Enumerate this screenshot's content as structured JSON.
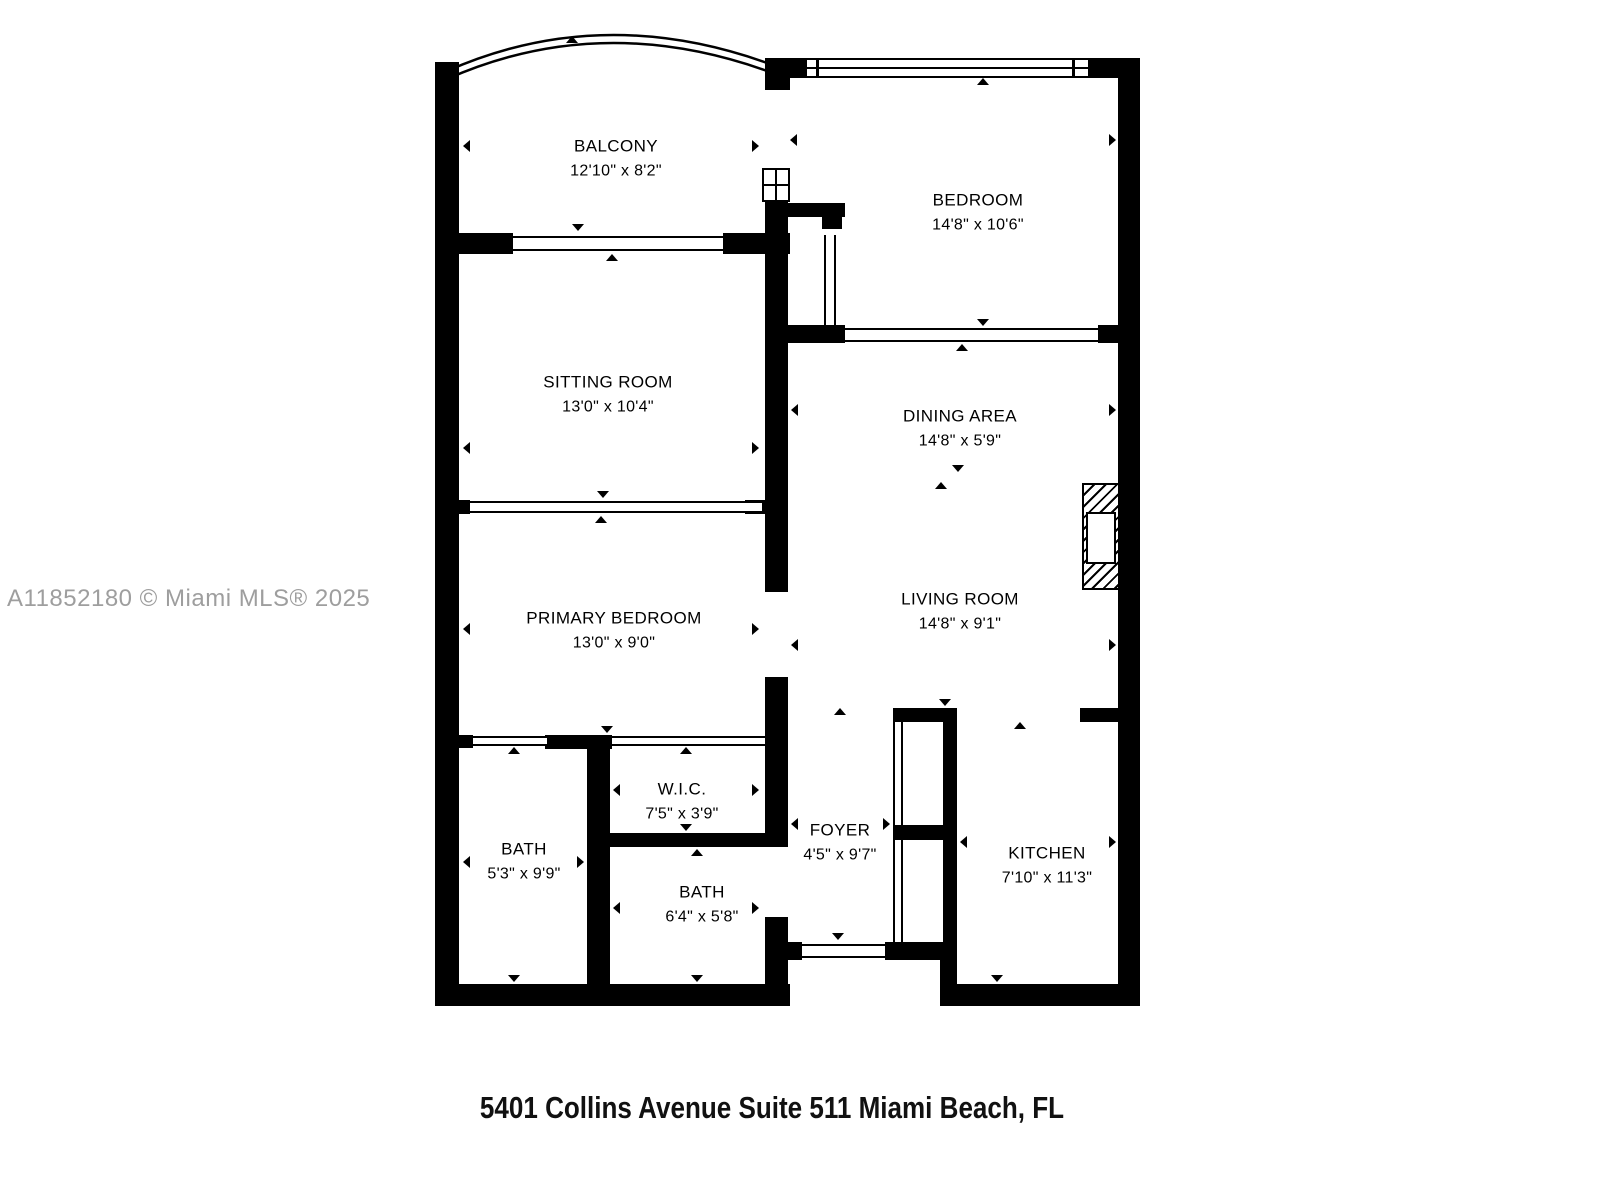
{
  "watermark": "A11852180 © Miami MLS® 2025",
  "caption": "5401 Collins Avenue Suite 511 Miami Beach, FL",
  "colors": {
    "wall": "#000000",
    "watermark_text": "#9e9e9e",
    "background": "#ffffff"
  },
  "rooms": [
    {
      "name": "BALCONY",
      "dims": "12'10\" x 8'2\""
    },
    {
      "name": "BEDROOM",
      "dims": "14'8\" x 10'6\""
    },
    {
      "name": "SITTING ROOM",
      "dims": "13'0\" x 10'4\""
    },
    {
      "name": "DINING AREA",
      "dims": "14'8\" x 5'9\""
    },
    {
      "name": "PRIMARY BEDROOM",
      "dims": "13'0\" x 9'0\""
    },
    {
      "name": "LIVING ROOM",
      "dims": "14'8\" x 9'1\""
    },
    {
      "name": "W.I.C.",
      "dims": "7'5\" x 3'9\""
    },
    {
      "name": "BATH",
      "dims": "5'3\" x 9'9\""
    },
    {
      "name": "BATH",
      "dims": "6'4\" x 5'8\""
    },
    {
      "name": "FOYER",
      "dims": "4'5\" x 9'7\""
    },
    {
      "name": "KITCHEN",
      "dims": "7'10\" x 11'3\""
    }
  ]
}
